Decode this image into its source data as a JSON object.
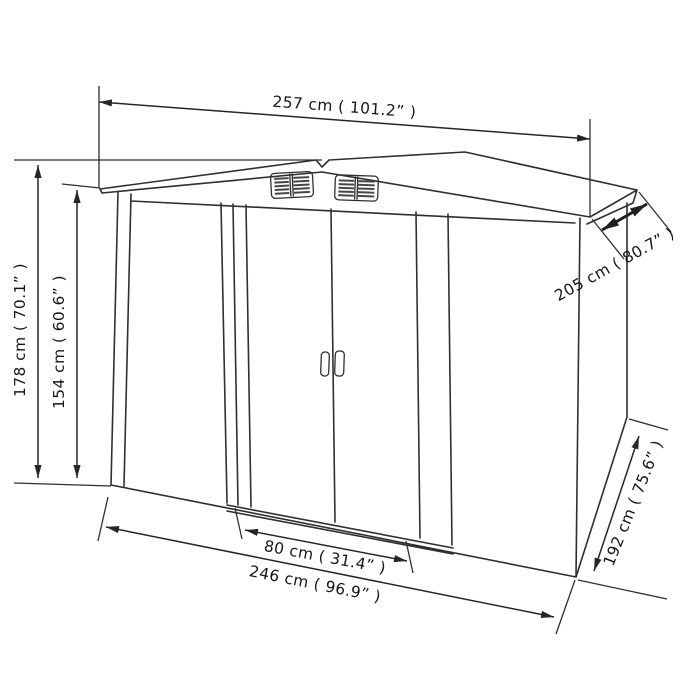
{
  "drawing": {
    "title": "Garden storage shed dimension diagram",
    "background": "#ffffff",
    "line_color": "#2f2f2f",
    "text_color": "#161616",
    "dimensions": {
      "roof_width": "257 cm ( 101.2” )",
      "roof_depth": "205 cm ( 80.7” )",
      "total_height": "178 cm ( 70.1” )",
      "wall_height": "154 cm ( 60.6” )",
      "door_width": "80 cm ( 31.4” )",
      "base_width": "246 cm ( 96.9” )",
      "base_depth": "192 cm ( 75.6” )"
    }
  }
}
